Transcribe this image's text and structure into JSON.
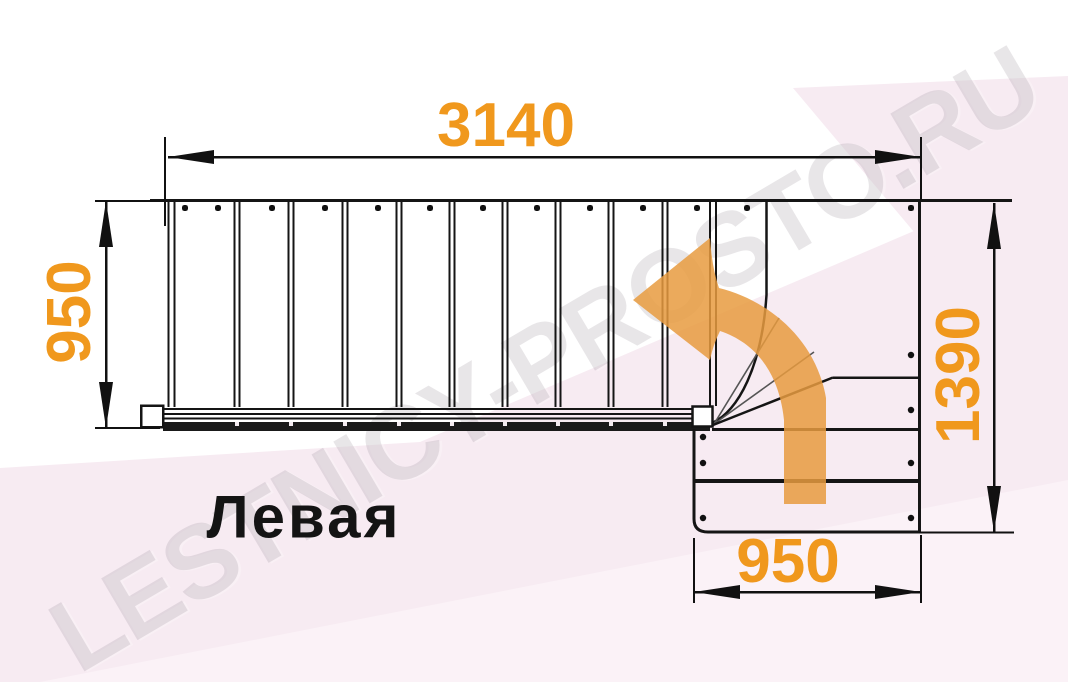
{
  "diagram": {
    "orientation_label": "Левая",
    "watermark": "LESTNICY-PROSTO.RU",
    "dimensions": {
      "top_width_mm": "3140",
      "left_depth_mm": "950",
      "right_depth_mm": "1390",
      "bottom_width_mm": "950"
    },
    "colors": {
      "dimension_text": "#f0981d",
      "turn_arrow_fill": "#e89b3f",
      "drawing_line": "#151515",
      "background_pink": "#f7ebf2",
      "background_pink_light": "#fbf2f7",
      "watermark_gray": "#948c98"
    }
  }
}
